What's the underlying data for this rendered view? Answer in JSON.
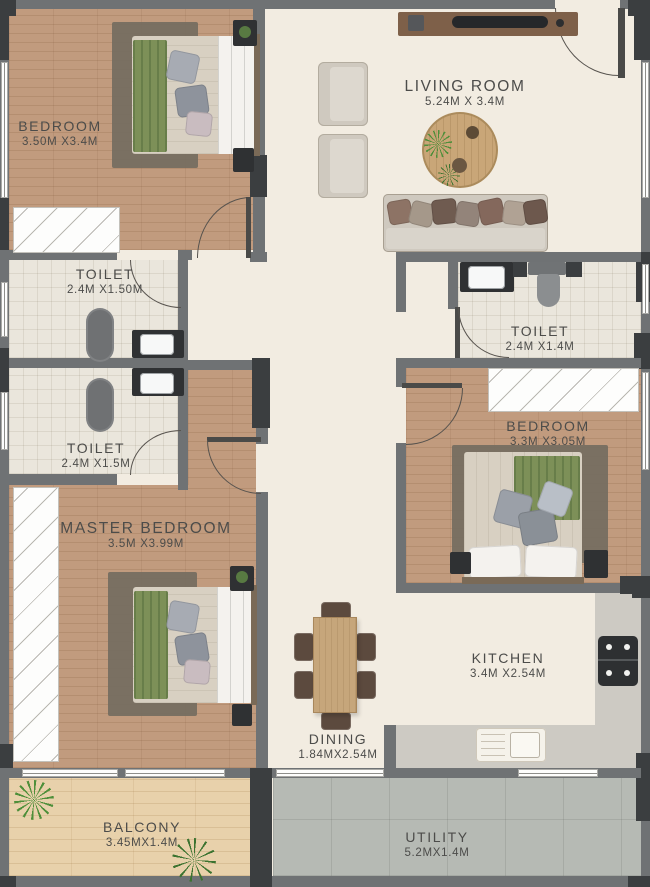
{
  "rooms": {
    "bedroom1": {
      "name": "BEDROOM",
      "dims": "3.50M X3.4M"
    },
    "living": {
      "name": "LIVING ROOM",
      "dims": "5.24M X 3.4M"
    },
    "toilet1": {
      "name": "TOILET",
      "dims": "2.4M X1.50M"
    },
    "toilet2": {
      "name": "TOILET",
      "dims": "2.4M X1.5M"
    },
    "toilet3": {
      "name": "TOILET",
      "dims": "2.4M X1.4M"
    },
    "master": {
      "name": "MASTER BEDROOM",
      "dims": "3.5M X3.99M"
    },
    "bedroom2": {
      "name": "BEDROOM",
      "dims": "3.3M X3.05M"
    },
    "kitchen": {
      "name": "KITCHEN",
      "dims": "3.4M X2.54M"
    },
    "dining": {
      "name": "DINING",
      "dims": "1.84MX2.54M"
    },
    "balcony": {
      "name": "BALCONY",
      "dims": "3.45MX1.4M"
    },
    "utility": {
      "name": "UTILITY",
      "dims": "5.2MX1.4M"
    }
  },
  "palette": {
    "wall": "#6f7274",
    "wall_dark": "#3b3e40",
    "wood_floor": "#c19b7e",
    "corridor_floor": "#f2ece1",
    "tile_floor": "#eae6dc",
    "balcony_floor": "#e8d1ab",
    "utility_floor": "#b6bab4",
    "label_text": "#4c4c4a",
    "blanket_green": "#7d9058"
  }
}
